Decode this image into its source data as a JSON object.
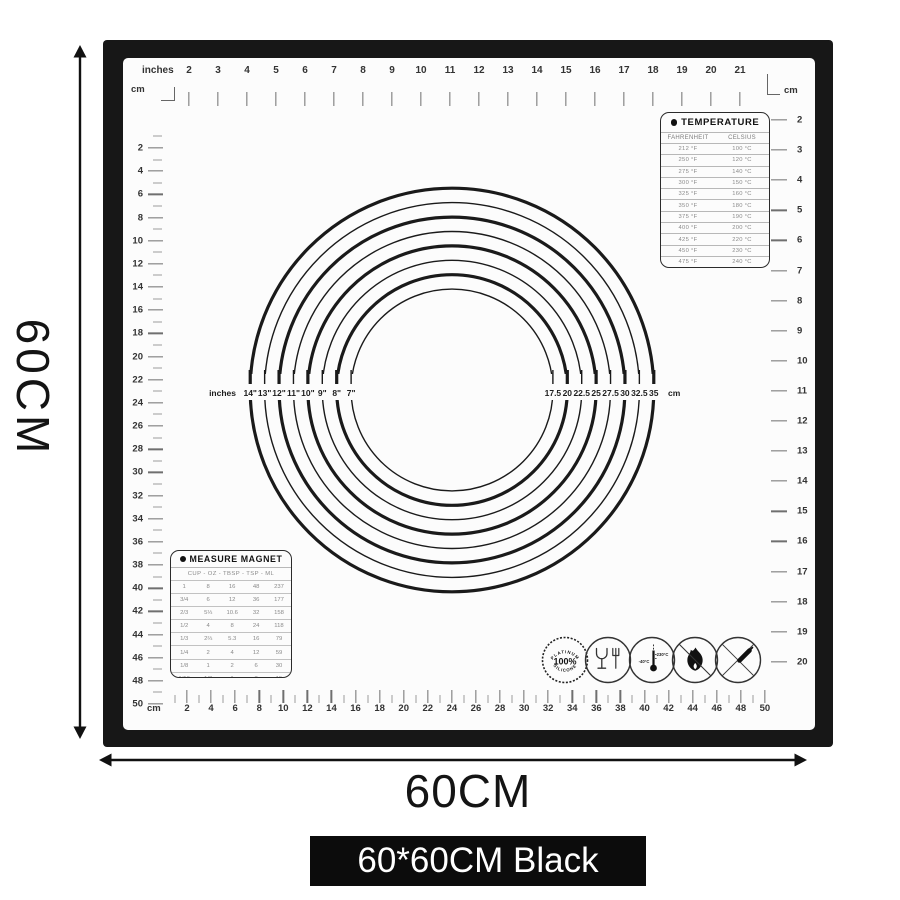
{
  "dimension_labels": {
    "height": "60CM",
    "width": "60CM",
    "variant": "60*60CM Black"
  },
  "rulers": {
    "top": {
      "unit_label": "inches",
      "corner_label": "cm",
      "numbers": [
        2,
        3,
        4,
        5,
        6,
        7,
        8,
        9,
        10,
        11,
        12,
        13,
        14,
        15,
        16,
        17,
        18,
        19,
        20,
        21
      ]
    },
    "left": {
      "unit_label": "cm",
      "numbers": [
        2,
        4,
        6,
        8,
        10,
        12,
        14,
        16,
        18,
        20,
        22,
        24,
        26,
        28,
        30,
        32,
        34,
        36,
        38,
        40,
        42,
        44,
        46,
        48,
        50
      ]
    },
    "right": {
      "unit_label": "cm",
      "numbers": [
        2,
        3,
        4,
        5,
        6,
        7,
        8,
        9,
        10,
        11,
        12,
        13,
        14,
        15,
        16,
        17,
        18,
        19,
        20
      ]
    },
    "bottom": {
      "unit_label": "cm",
      "numbers": [
        2,
        4,
        6,
        8,
        10,
        12,
        14,
        16,
        18,
        20,
        22,
        24,
        26,
        28,
        30,
        32,
        34,
        36,
        38,
        40,
        42,
        44,
        46,
        48,
        50
      ]
    }
  },
  "temperature_table": {
    "title": "TEMPERATURE",
    "columns": [
      "FAHRENHEIT",
      "CELSIUS"
    ],
    "rows": [
      [
        "212 °F",
        "100 °C"
      ],
      [
        "250 °F",
        "120 °C"
      ],
      [
        "275 °F",
        "140 °C"
      ],
      [
        "300 °F",
        "150 °C"
      ],
      [
        "325 °F",
        "160 °C"
      ],
      [
        "350 °F",
        "180 °C"
      ],
      [
        "375 °F",
        "190 °C"
      ],
      [
        "400 °F",
        "200 °C"
      ],
      [
        "425 °F",
        "220 °C"
      ],
      [
        "450 °F",
        "230 °C"
      ],
      [
        "475 °F",
        "240 °C"
      ],
      [
        "500 °F",
        "260 °C"
      ]
    ]
  },
  "measure_table": {
    "title": "MEASURE MAGNET",
    "columns": [
      "CUP",
      "OZ",
      "TBSP",
      "TSP",
      "ML"
    ],
    "rows": [
      [
        "1",
        "8",
        "16",
        "48",
        "237"
      ],
      [
        "3/4",
        "6",
        "12",
        "36",
        "177"
      ],
      [
        "2/3",
        "5⅓",
        "10.6",
        "32",
        "158"
      ],
      [
        "1/2",
        "4",
        "8",
        "24",
        "118"
      ],
      [
        "1/3",
        "2⅔",
        "5.3",
        "16",
        "79"
      ],
      [
        "1/4",
        "2",
        "4",
        "12",
        "59"
      ],
      [
        "1/8",
        "1",
        "2",
        "6",
        "30"
      ],
      [
        "1/16",
        "1/2",
        "1",
        "3",
        "15"
      ]
    ]
  },
  "circle_guide": {
    "left_unit_label": "inches",
    "right_unit_label": "cm",
    "rings": [
      {
        "inch_label": "14\"",
        "cm_label": "35",
        "diameter_cm": 35,
        "weight": "thick"
      },
      {
        "inch_label": "13\"",
        "cm_label": "32.5",
        "diameter_cm": 32.5,
        "weight": "thin"
      },
      {
        "inch_label": "12\"",
        "cm_label": "30",
        "diameter_cm": 30,
        "weight": "thick"
      },
      {
        "inch_label": "11\"",
        "cm_label": "27.5",
        "diameter_cm": 27.5,
        "weight": "thin"
      },
      {
        "inch_label": "10\"",
        "cm_label": "25",
        "diameter_cm": 25,
        "weight": "thick"
      },
      {
        "inch_label": "9\"",
        "cm_label": "22.5",
        "diameter_cm": 22.5,
        "weight": "thin"
      },
      {
        "inch_label": "8\"",
        "cm_label": "20",
        "diameter_cm": 20,
        "weight": "thick"
      },
      {
        "inch_label": "7\"",
        "cm_label": "17.5",
        "diameter_cm": 17.5,
        "weight": "thin"
      }
    ]
  },
  "certification_icons": {
    "names": [
      "platinum-silicone-badge-icon",
      "glass-fork-food-safe-icon",
      "temperature-range-icon",
      "no-open-flame-icon",
      "no-knife-icon"
    ],
    "platinum_badge": {
      "top": "PLATINUM",
      "center": "100%",
      "bottom": "SILICONE"
    },
    "temp_range": {
      "min": "-40°C",
      "max": "230°C"
    }
  },
  "colors": {
    "mat_frame": "#171717",
    "mat_surface": "#fcfcfc",
    "ink": "#1a1a1a",
    "badge_bg": "#0c0c0c"
  }
}
